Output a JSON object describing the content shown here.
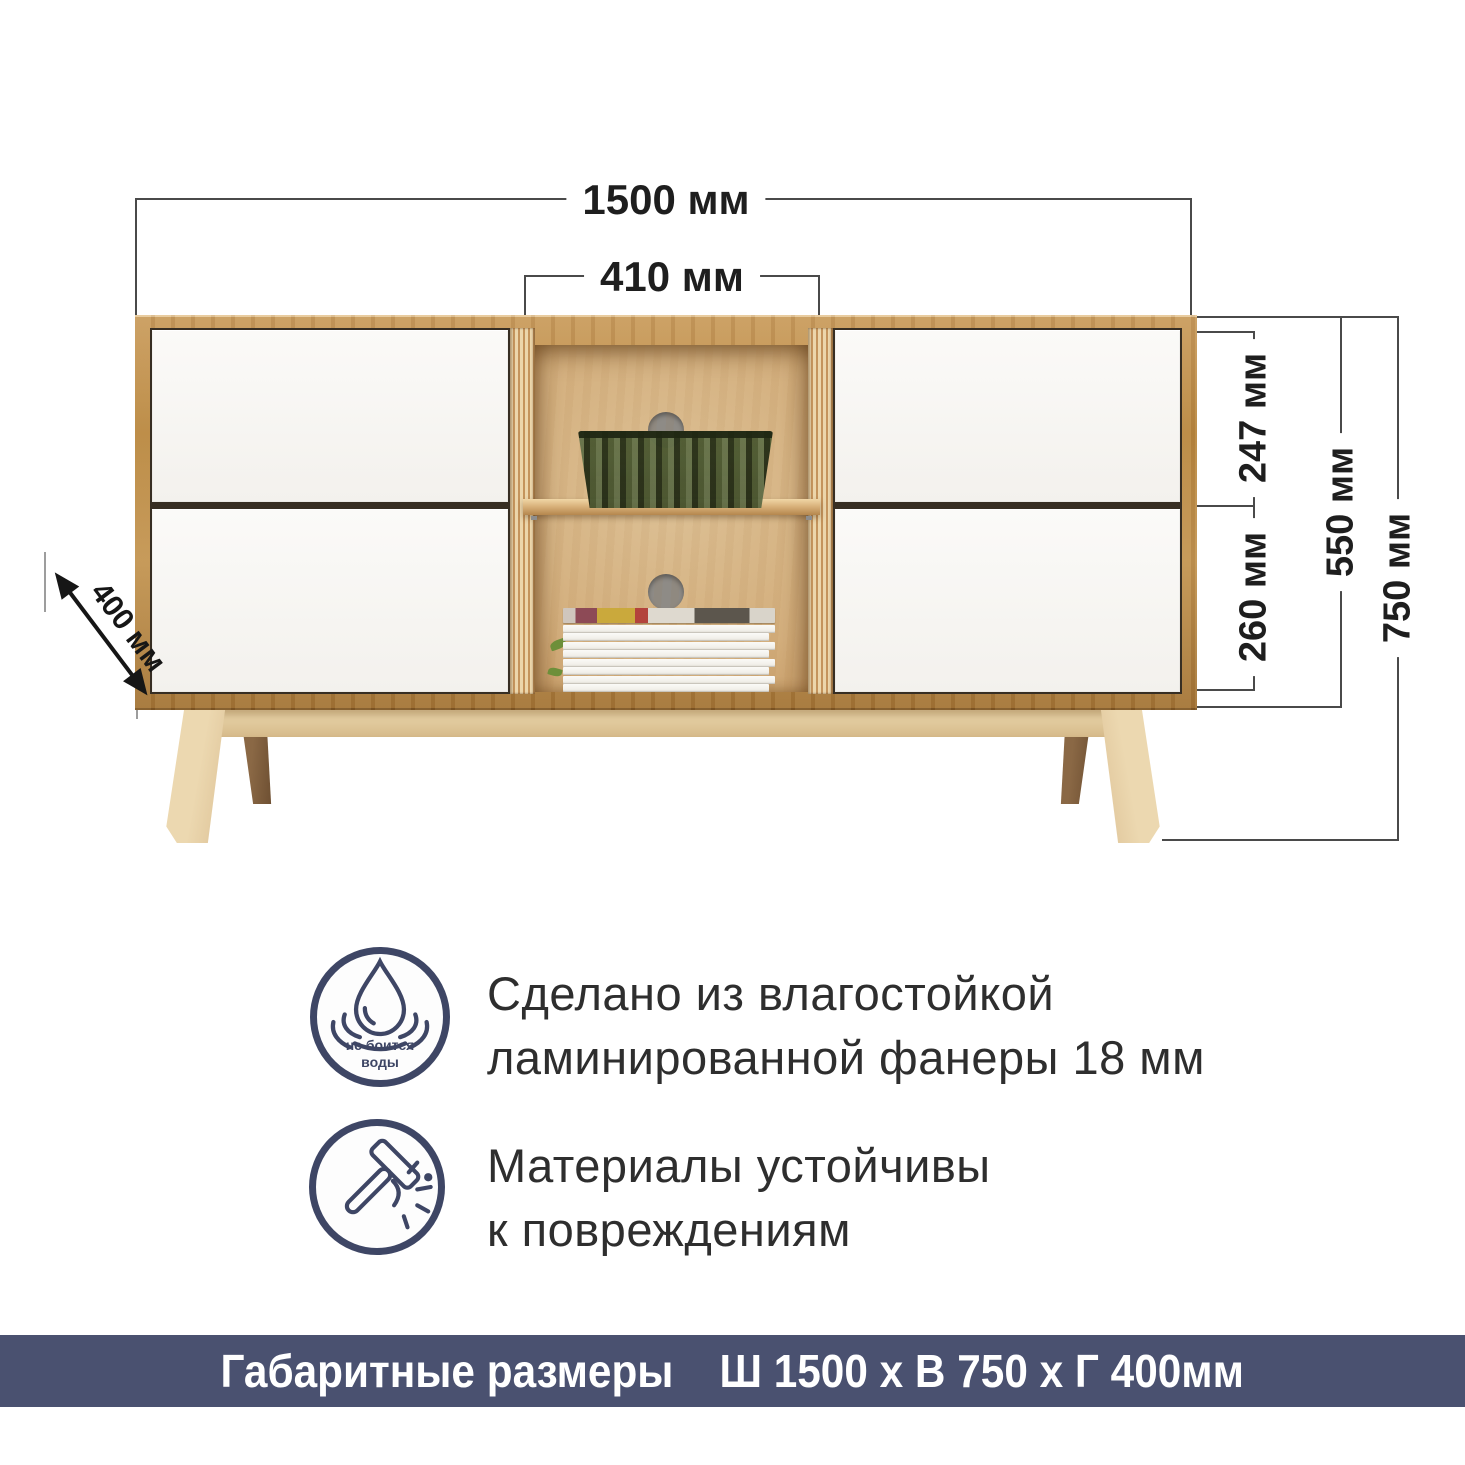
{
  "dimensions": {
    "overall_width": "1500 мм",
    "opening_width": "410 мм",
    "top_drawer_height": "247 мм",
    "bottom_drawer_height": "260 мм",
    "body_height": "550 мм",
    "overall_height": "750 мм",
    "depth": "400 мм"
  },
  "features": [
    {
      "icon": "water-resistant-icon",
      "badge_line1": "не боится",
      "badge_line2": "воды",
      "line1": "Сделано из влагостойкой",
      "line2": "ламинированной фанеры 18 мм"
    },
    {
      "icon": "impact-resistant-icon",
      "line1": "Материалы устойчивы",
      "line2": "к повреждениям"
    }
  ],
  "footer": {
    "label": "Габаритные размеры",
    "value": "Ш 1500 х В 750 х Г 400мм"
  },
  "colors": {
    "accent_navy": "#3e4665",
    "footer_bg": "#4a5170",
    "dimension_line": "#4a4a4a",
    "wood_frame": "#bd8c4d",
    "plywood_interior": "#d6b486",
    "drawer_front": "#f9f8f6"
  }
}
